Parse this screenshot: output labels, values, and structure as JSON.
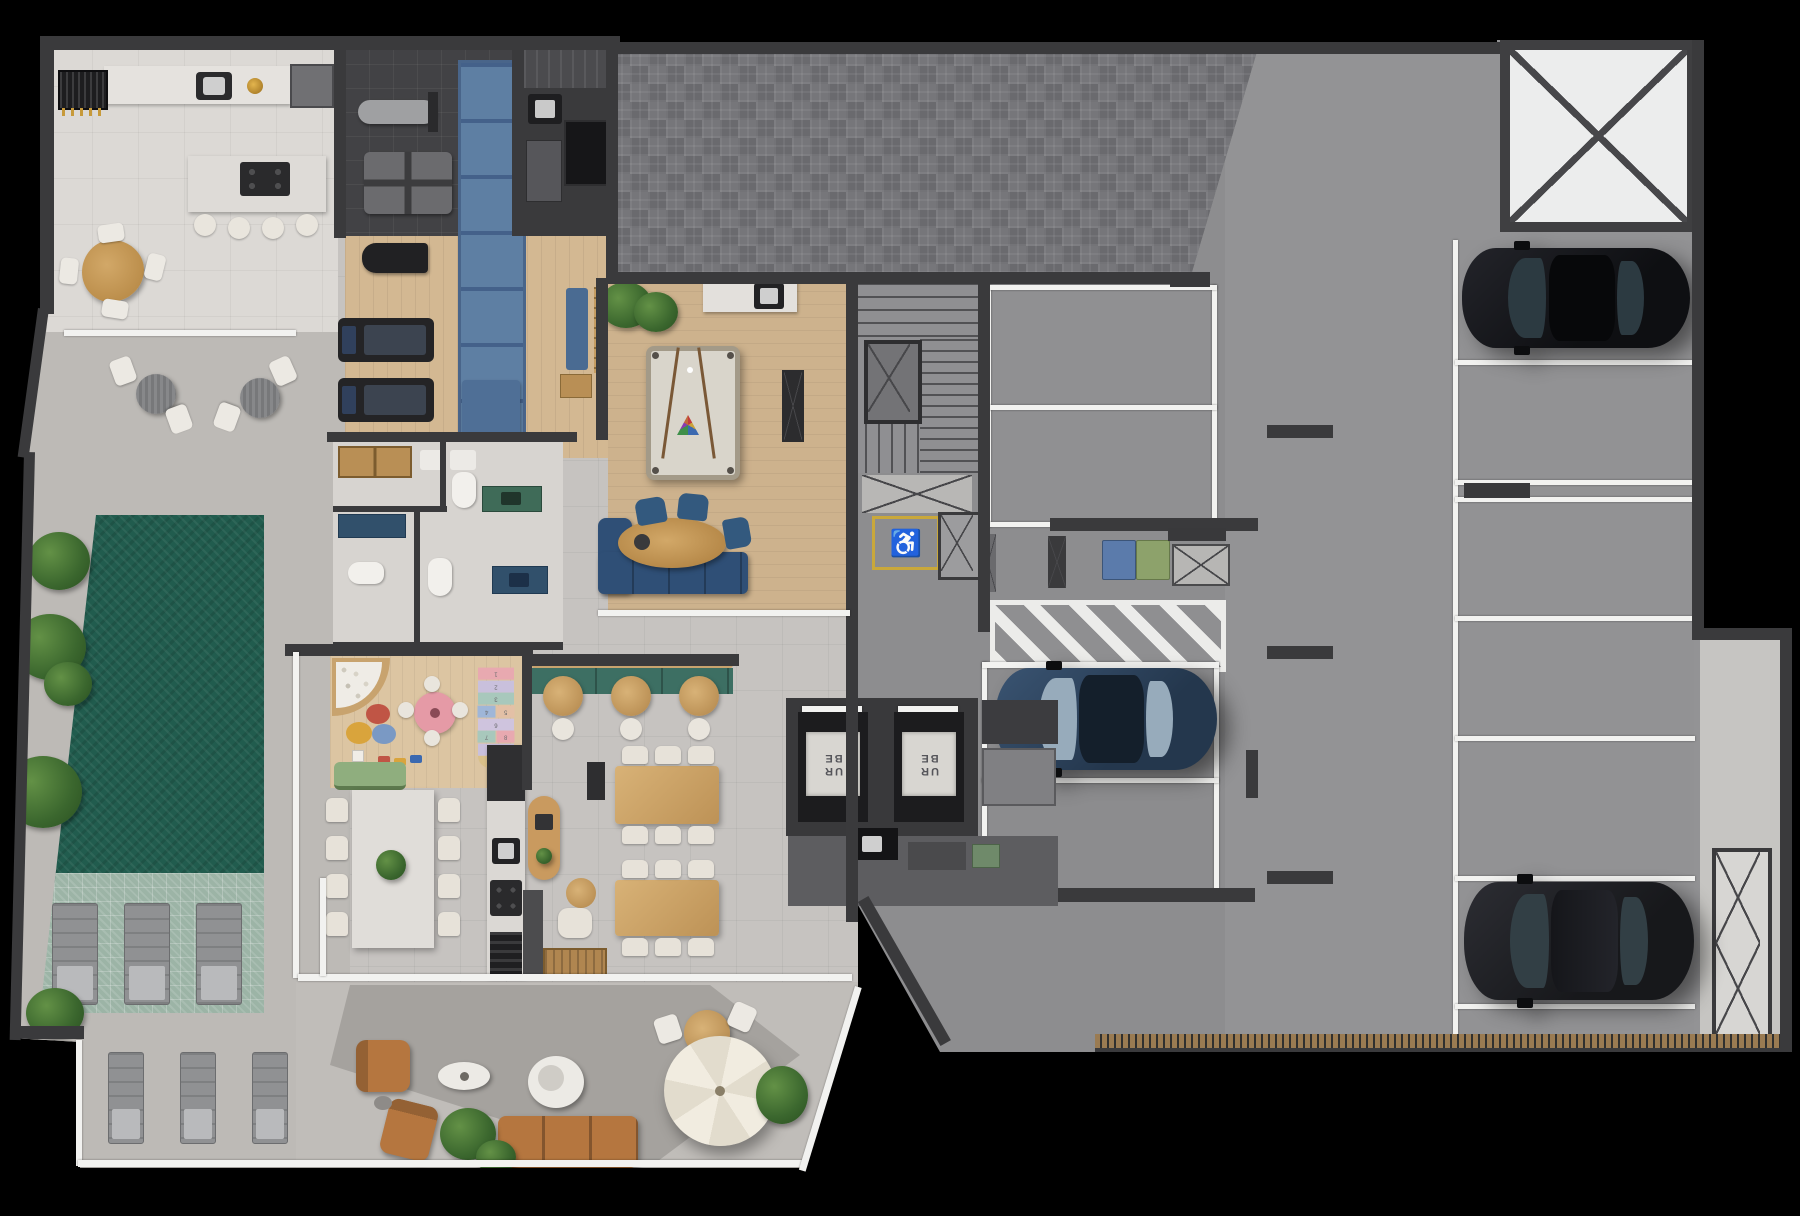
{
  "scene": {
    "background": "#000000"
  },
  "elevators": {
    "count": 2,
    "cab_label_line1": "UR",
    "cab_label_line2": "BE"
  },
  "signage": {
    "accessible_symbol": "♿",
    "accessible_color": "#c9a83b"
  },
  "kids_room": {
    "hopscotch_numbers": [
      "1",
      "2",
      "3",
      "4",
      "5",
      "6",
      "7",
      "8",
      "9",
      "10"
    ]
  },
  "palette": {
    "wall": "#3a3a3c",
    "marble_floor": "#dcd9d5",
    "tile_floor": "#c6c3c0",
    "wood_floor": "#d2b691",
    "paver_court": "#707073",
    "garage_concrete": "#8d8d8f",
    "pool_water": "#215c4e",
    "pool_shallow": "#9cb4a6",
    "gym_track_blue": "#5e7fa3",
    "sofa_navy": "#2f4f76",
    "sofa_caramel": "#b5763f",
    "bench_teal": "#3d6f63",
    "kids_pink": "#e59aa6",
    "bin_blue": "#5b7bab",
    "bin_green": "#8da26b",
    "car_black": "#101114",
    "car_blue": "#24374d",
    "accessibility_yellow": "#c9a83b",
    "umbrella_cream": "#efe9dc"
  }
}
